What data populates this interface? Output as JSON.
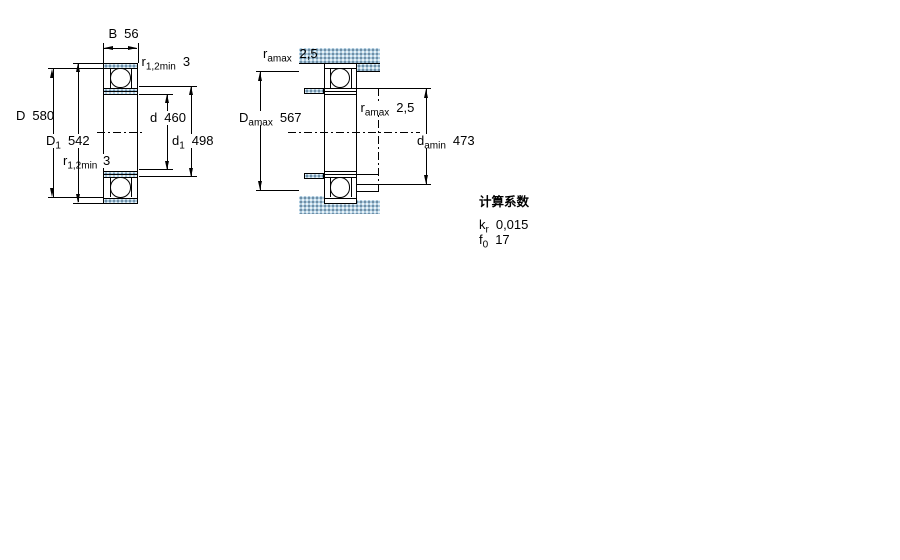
{
  "drawing": {
    "left_view": {
      "width_B": {
        "sym": "B",
        "val": "56"
      },
      "r_top": {
        "sym": "r",
        "sub": "1,2min",
        "val": "3"
      },
      "outer_D": {
        "sym": "D",
        "val": "580"
      },
      "shoulder_D1": {
        "sym": "D",
        "sub": "1",
        "val": "542"
      },
      "r_mid": {
        "sym": "r",
        "sub": "1,2min",
        "val": "3"
      },
      "bore_d": {
        "sym": "d",
        "val": "460"
      },
      "shoulder_d1": {
        "sym": "d",
        "sub": "1",
        "val": "498"
      }
    },
    "right_view": {
      "ra_top": {
        "sym": "r",
        "sub": "amax",
        "val": "2,5"
      },
      "Da_max": {
        "sym": "D",
        "sub": "amax",
        "val": "567"
      },
      "ra_mid": {
        "sym": "r",
        "sub": "amax",
        "val": "2,5"
      },
      "da_min": {
        "sym": "d",
        "sub": "amin",
        "val": "473"
      }
    },
    "calculation_factors": {
      "title": "计算系数",
      "kr": {
        "sym": "k",
        "sub": "r",
        "val": "0,015"
      },
      "f0": {
        "sym": "f",
        "sub": "0",
        "val": "17"
      }
    },
    "colors": {
      "line": "#000000",
      "section_fill": "#abcade",
      "background": "#ffffff"
    }
  }
}
